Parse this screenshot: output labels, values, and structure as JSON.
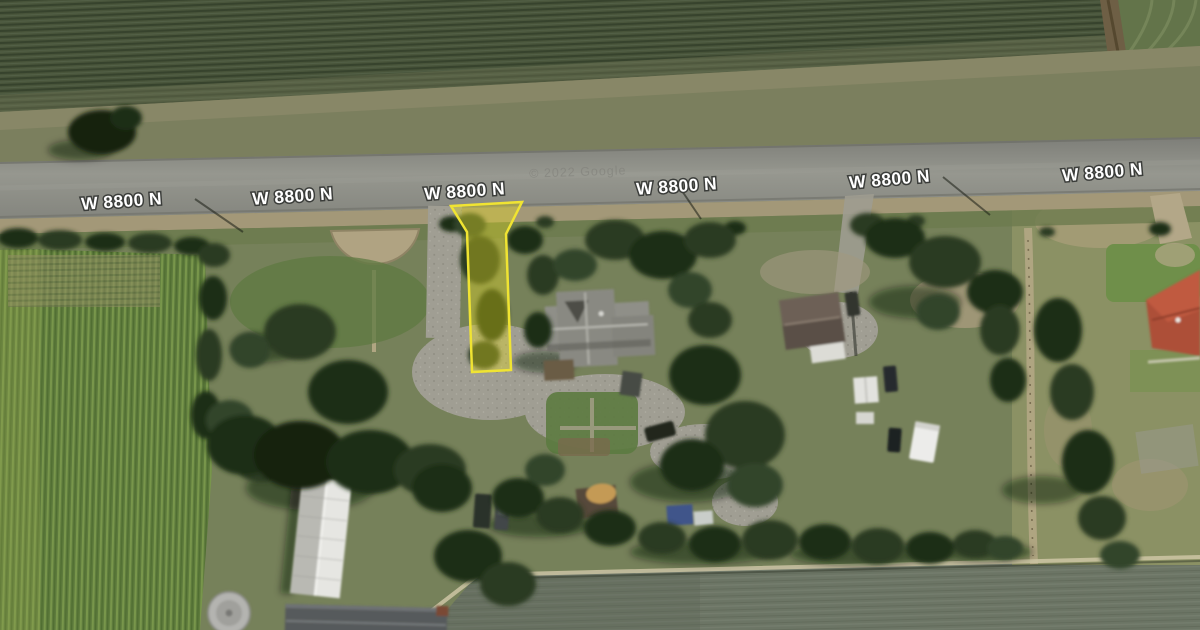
{
  "map": {
    "type": "satellite-aerial-view",
    "watermark": "© 2022 Google",
    "label_color": "#ffffff",
    "label_outline": "#3b3d3a",
    "road_labels": [
      {
        "text": "W 8800 N",
        "x": 122,
        "y": 207,
        "rotation": -4
      },
      {
        "text": "W 8800 N",
        "x": 293,
        "y": 202,
        "rotation": -4
      },
      {
        "text": "W 8800 N",
        "x": 465,
        "y": 197,
        "rotation": -4
      },
      {
        "text": "W 8800 N",
        "x": 677,
        "y": 192,
        "rotation": -4
      },
      {
        "text": "W 8800 N",
        "x": 890,
        "y": 185,
        "rotation": -5
      },
      {
        "text": "W 8800 N",
        "x": 1103,
        "y": 178,
        "rotation": -5
      }
    ]
  },
  "parcel": {
    "points": "451,206 522,202 506,234 511,370 472,372 467,232",
    "stroke": "#f0e432",
    "fill": "rgba(228,218,30,0.38)",
    "stroke_width": 2.5
  }
}
